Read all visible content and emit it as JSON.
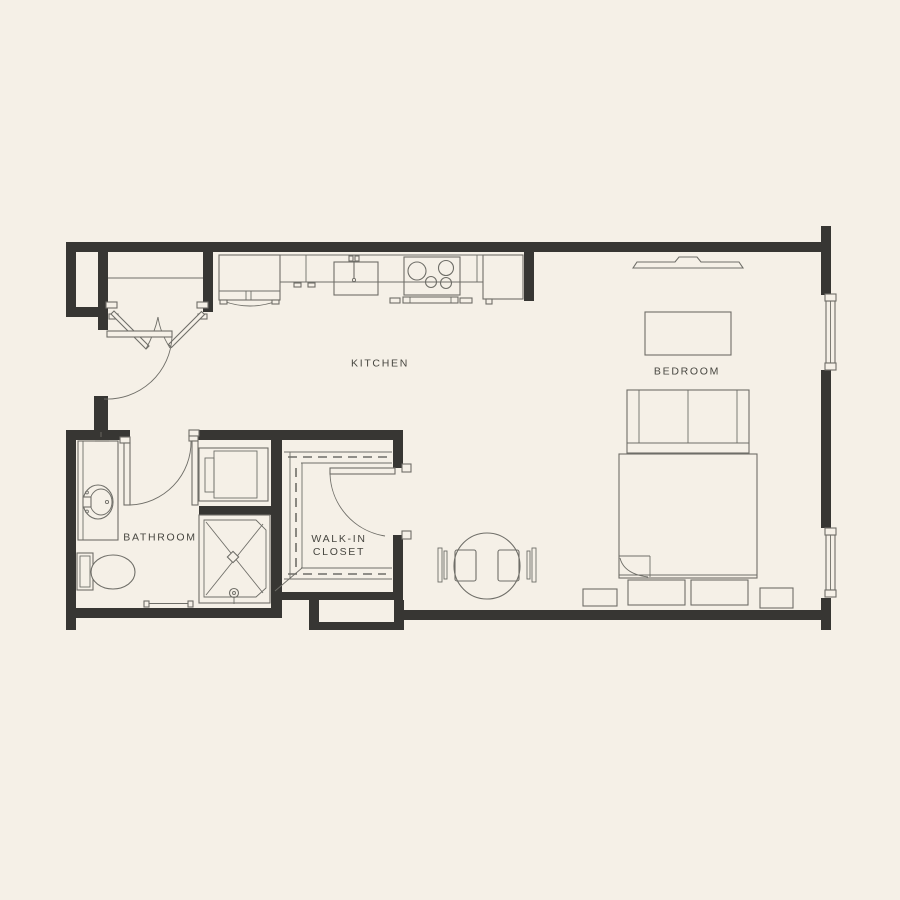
{
  "colors": {
    "background": "#f5f0e7",
    "wall": "#373633",
    "line": "#6f6e68",
    "label": "#474640"
  },
  "rooms": {
    "kitchen": {
      "label": "KITCHEN"
    },
    "bedroom": {
      "label": "BEDROOM"
    },
    "bathroom": {
      "label": "BATHROOM"
    },
    "closet": {
      "line1": "WALK-IN",
      "line2": "CLOSET"
    }
  }
}
